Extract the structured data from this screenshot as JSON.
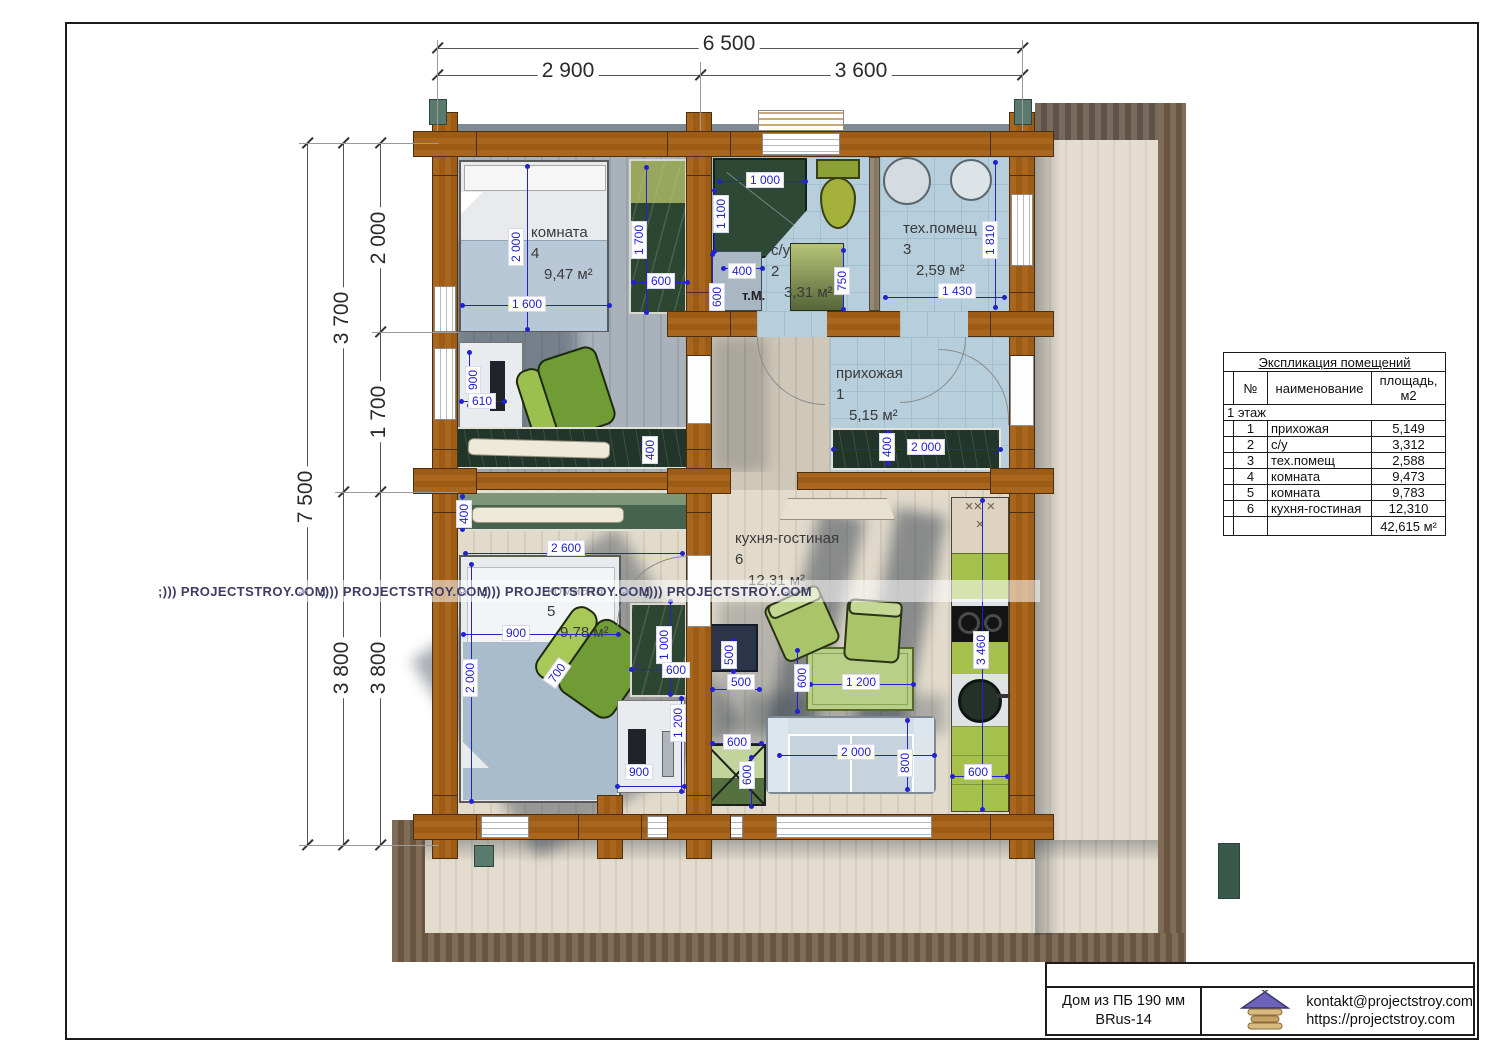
{
  "plan": {
    "watermark_text": ";))) PROJECTSTROY.COM",
    "watermarks": [
      {
        "x": 158,
        "y": 584
      },
      {
        "x": 320,
        "y": 584
      },
      {
        "x": 482,
        "y": 584
      },
      {
        "x": 644,
        "y": 584
      }
    ],
    "watermark_icons": [
      {
        "x": 298,
        "y": 585
      },
      {
        "x": 460,
        "y": 585
      },
      {
        "x": 622,
        "y": 585
      },
      {
        "x": 784,
        "y": 585
      }
    ],
    "washer_label": "т.М.",
    "rooms": [
      {
        "name": "комната",
        "num": "4",
        "area": "9,47 м²",
        "x": 531,
        "y": 222
      },
      {
        "name": "с/у",
        "num": "2",
        "area": "3,31 м²",
        "x": 771,
        "y": 240
      },
      {
        "name": "тех.помещ",
        "num": "3",
        "area": "2,59 м²",
        "x": 903,
        "y": 218
      },
      {
        "name": "прихожая",
        "num": "1",
        "area": "5,15 м²",
        "x": 836,
        "y": 363
      },
      {
        "name": "комната",
        "num": "5",
        "area": "9,78 м²",
        "x": 547,
        "y": 580
      },
      {
        "name": "кухня-гостиная",
        "num": "6",
        "area": "12,31 м²",
        "x": 735,
        "y": 528
      }
    ],
    "outer_dims": [
      {
        "t": "6 500",
        "x": 729,
        "y": 44,
        "r": 0
      },
      {
        "t": "2 900",
        "x": 568,
        "y": 71,
        "r": 0
      },
      {
        "t": "3 600",
        "x": 861,
        "y": 71,
        "r": 0
      },
      {
        "t": "7 500",
        "x": 306,
        "y": 497,
        "r": -90
      },
      {
        "t": "3 700",
        "x": 342,
        "y": 318,
        "r": -90
      },
      {
        "t": "3 800",
        "x": 342,
        "y": 668,
        "r": -90
      },
      {
        "t": "2 000",
        "x": 379,
        "y": 238,
        "r": -90
      },
      {
        "t": "1 700",
        "x": 379,
        "y": 412,
        "r": -90
      },
      {
        "t": "3 800",
        "x": 379,
        "y": 668,
        "r": -90
      }
    ],
    "outer_lines": [
      {
        "x": 437,
        "y": 48,
        "len": 585,
        "o": "h",
        "ticks": [
          0,
          585
        ]
      },
      {
        "x": 437,
        "y": 75,
        "len": 585,
        "o": "h",
        "ticks": [
          0,
          263,
          585
        ]
      },
      {
        "x": 307,
        "y": 143,
        "len": 702,
        "o": "v",
        "ticks": [
          0,
          702
        ]
      },
      {
        "x": 343,
        "y": 143,
        "len": 702,
        "o": "v",
        "ticks": [
          0,
          349,
          702
        ]
      },
      {
        "x": 380,
        "y": 143,
        "len": 702,
        "o": "v",
        "ticks": [
          0,
          189,
          349,
          702
        ]
      }
    ],
    "ext_lines": [
      {
        "x": 437,
        "y": 40,
        "len": 91,
        "o": "v"
      },
      {
        "x": 700,
        "y": 62,
        "len": 69,
        "o": "v"
      },
      {
        "x": 1022,
        "y": 40,
        "len": 91,
        "o": "v"
      },
      {
        "x": 299,
        "y": 143,
        "len": 140,
        "o": "h"
      },
      {
        "x": 299,
        "y": 845,
        "len": 140,
        "o": "h"
      },
      {
        "x": 335,
        "y": 492,
        "len": 123,
        "o": "h"
      },
      {
        "x": 372,
        "y": 332,
        "len": 86,
        "o": "h"
      }
    ],
    "inner_dims": [
      {
        "t": "2 000",
        "x": 516,
        "y": 247,
        "r": -90
      },
      {
        "t": "1 600",
        "x": 527,
        "y": 304,
        "r": 0
      },
      {
        "t": "1 700",
        "x": 639,
        "y": 240,
        "r": -90
      },
      {
        "t": "600",
        "x": 661,
        "y": 281,
        "r": 0
      },
      {
        "t": "900",
        "x": 473,
        "y": 380,
        "r": -90
      },
      {
        "t": "610",
        "x": 482,
        "y": 401,
        "r": 0
      },
      {
        "t": "400",
        "x": 650,
        "y": 450,
        "r": -90
      },
      {
        "t": "1 000",
        "x": 765,
        "y": 180,
        "r": 0
      },
      {
        "t": "1 100",
        "x": 721,
        "y": 214,
        "r": -90
      },
      {
        "t": "400",
        "x": 742,
        "y": 271,
        "r": 0
      },
      {
        "t": "600",
        "x": 717,
        "y": 297,
        "r": -90
      },
      {
        "t": "750",
        "x": 842,
        "y": 281,
        "r": -90
      },
      {
        "t": "1 430",
        "x": 957,
        "y": 291,
        "r": 0
      },
      {
        "t": "1 810",
        "x": 990,
        "y": 240,
        "r": -90
      },
      {
        "t": "2 000",
        "x": 926,
        "y": 447,
        "r": 0
      },
      {
        "t": "400",
        "x": 887,
        "y": 447,
        "r": -90
      },
      {
        "t": "400",
        "x": 464,
        "y": 514,
        "r": -90
      },
      {
        "t": "2 600",
        "x": 566,
        "y": 548,
        "r": 0
      },
      {
        "t": "900",
        "x": 516,
        "y": 633,
        "r": 0
      },
      {
        "t": "2 000",
        "x": 470,
        "y": 678,
        "r": -90
      },
      {
        "t": "700",
        "x": 557,
        "y": 673,
        "r": -55
      },
      {
        "t": "1 000",
        "x": 664,
        "y": 645,
        "r": -90
      },
      {
        "t": "600",
        "x": 676,
        "y": 670,
        "r": 0
      },
      {
        "t": "1 200",
        "x": 678,
        "y": 723,
        "r": -90
      },
      {
        "t": "900",
        "x": 639,
        "y": 772,
        "r": 0
      },
      {
        "t": "500",
        "x": 729,
        "y": 655,
        "r": -90
      },
      {
        "t": "500",
        "x": 741,
        "y": 682,
        "r": 0
      },
      {
        "t": "600",
        "x": 802,
        "y": 678,
        "r": -90
      },
      {
        "t": "1 200",
        "x": 861,
        "y": 682,
        "r": 0
      },
      {
        "t": "3 460",
        "x": 981,
        "y": 650,
        "r": -90
      },
      {
        "t": "600",
        "x": 737,
        "y": 742,
        "r": 0
      },
      {
        "t": "600",
        "x": 747,
        "y": 775,
        "r": -90
      },
      {
        "t": "2 000",
        "x": 856,
        "y": 752,
        "r": 0
      },
      {
        "t": "800",
        "x": 905,
        "y": 763,
        "r": -90
      },
      {
        "t": "600",
        "x": 978,
        "y": 772,
        "r": 0
      }
    ],
    "inner_lines": [
      {
        "x": 527,
        "y": 166,
        "len": 164,
        "o": "v"
      },
      {
        "x": 462,
        "y": 305,
        "len": 148,
        "o": "h"
      },
      {
        "x": 646,
        "y": 167,
        "len": 146,
        "o": "v"
      },
      {
        "x": 633,
        "y": 282,
        "len": 55,
        "o": "h"
      },
      {
        "x": 469,
        "y": 352,
        "len": 54,
        "o": "v"
      },
      {
        "x": 461,
        "y": 401,
        "len": 44,
        "o": "h"
      },
      {
        "x": 719,
        "y": 181,
        "len": 87,
        "o": "h"
      },
      {
        "x": 714,
        "y": 190,
        "len": 62,
        "o": "v"
      },
      {
        "x": 723,
        "y": 268,
        "len": 40,
        "o": "h"
      },
      {
        "x": 712,
        "y": 254,
        "len": 56,
        "o": "v"
      },
      {
        "x": 843,
        "y": 250,
        "len": 60,
        "o": "v"
      },
      {
        "x": 885,
        "y": 297,
        "len": 120,
        "o": "h"
      },
      {
        "x": 995,
        "y": 162,
        "len": 146,
        "o": "v"
      },
      {
        "x": 833,
        "y": 449,
        "len": 168,
        "o": "h"
      },
      {
        "x": 888,
        "y": 432,
        "len": 32,
        "o": "v"
      },
      {
        "x": 462,
        "y": 496,
        "len": 34,
        "o": "v"
      },
      {
        "x": 465,
        "y": 553,
        "len": 218,
        "o": "h"
      },
      {
        "x": 471,
        "y": 564,
        "len": 238,
        "o": "v"
      },
      {
        "x": 463,
        "y": 634,
        "len": 156,
        "o": "h"
      },
      {
        "x": 670,
        "y": 601,
        "len": 94,
        "o": "v"
      },
      {
        "x": 631,
        "y": 669,
        "len": 55,
        "o": "h"
      },
      {
        "x": 681,
        "y": 698,
        "len": 94,
        "o": "v"
      },
      {
        "x": 617,
        "y": 786,
        "len": 68,
        "o": "h"
      },
      {
        "x": 733,
        "y": 640,
        "len": 32,
        "o": "v"
      },
      {
        "x": 712,
        "y": 689,
        "len": 48,
        "o": "h"
      },
      {
        "x": 810,
        "y": 684,
        "len": 104,
        "o": "h"
      },
      {
        "x": 797,
        "y": 650,
        "len": 62,
        "o": "v"
      },
      {
        "x": 982,
        "y": 500,
        "len": 310,
        "o": "v"
      },
      {
        "x": 779,
        "y": 755,
        "len": 156,
        "o": "h"
      },
      {
        "x": 907,
        "y": 720,
        "len": 70,
        "o": "v"
      },
      {
        "x": 712,
        "y": 743,
        "len": 50,
        "o": "h"
      },
      {
        "x": 751,
        "y": 757,
        "len": 50,
        "o": "v"
      },
      {
        "x": 952,
        "y": 776,
        "len": 56,
        "o": "h"
      }
    ]
  },
  "legend_table": {
    "title": "Экспликация помещений",
    "col_num": "№",
    "col_name": "наименование",
    "col_area_1": "площадь,",
    "col_area_2": "м2",
    "floor_row": "1 этаж",
    "rows": [
      {
        "num": "1",
        "name": "прихожая",
        "area": "5,149"
      },
      {
        "num": "2",
        "name": "с/у",
        "area": "3,312"
      },
      {
        "num": "3",
        "name": "тех.помещ",
        "area": "2,588"
      },
      {
        "num": "4",
        "name": "комната",
        "area": "9,473"
      },
      {
        "num": "5",
        "name": "комната",
        "area": "9,783"
      },
      {
        "num": "6",
        "name": "кухня-гостиная",
        "area": "12,310"
      }
    ],
    "total": "42,615 м²"
  },
  "title_block": {
    "project_line1": "Дом из ПБ 190 мм",
    "project_line2": "BRus-14",
    "email": "kontakt@projectstroy.com",
    "site": "https://projectstroy.com"
  },
  "colors": {
    "dim_blue": "#2222d0",
    "wall_brown": "#a7601a",
    "cabinet_green": "#2c4632",
    "kitchen_green": "#a6c04c",
    "chair_green": "#7aa83c",
    "tile_blue": "#b7cedc"
  }
}
